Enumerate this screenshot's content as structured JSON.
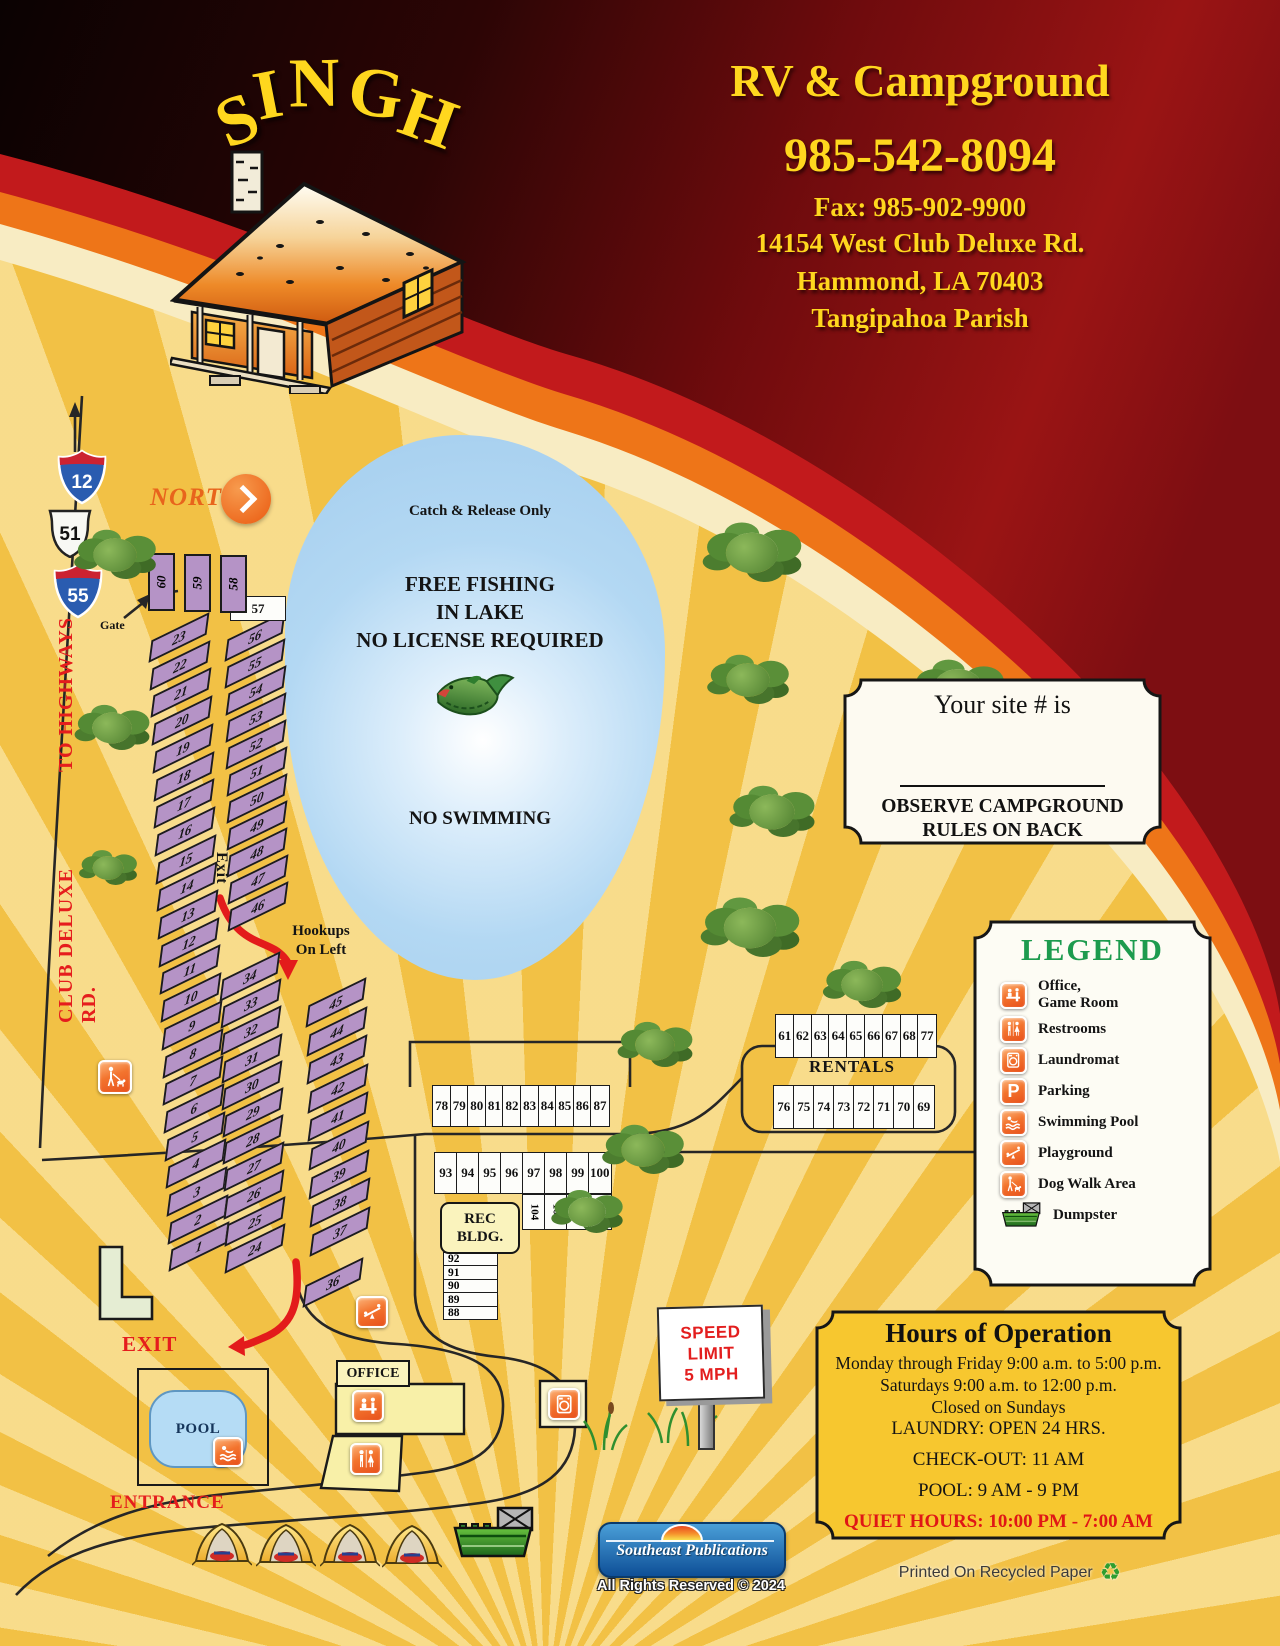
{
  "header": {
    "brand": "SINGH",
    "title": "RV & Campground",
    "phone": "985-542-8094",
    "fax": "Fax: 985-902-9900",
    "address1": "14154 West Club Deluxe Rd.",
    "address2": "Hammond, LA 70403",
    "address3": "Tangipahoa Parish"
  },
  "shields": {
    "i12": "12",
    "us51": "51",
    "i55": "55"
  },
  "labels": {
    "north": "NORTH",
    "gate": "Gate",
    "to_highways": "TO HIGHWAYS",
    "club_deluxe": "CLUB DELUXE RD.",
    "exit_lane": "Exit",
    "hookups1": "Hookups",
    "hookups2": "On Left",
    "exit": "EXIT",
    "entrance": "ENTRANCE",
    "pool": "POOL",
    "office": "OFFICE",
    "rec1": "REC",
    "rec2": "BLDG.",
    "rentals": "RENTALS"
  },
  "lake": {
    "line1": "Catch & Release Only",
    "f1": "FREE FISHING",
    "f2": "IN LAKE",
    "f3": "NO LICENSE REQUIRED",
    "no_swim": "NO SWIMMING"
  },
  "speed_sign": {
    "l1": "SPEED",
    "l2": "LIMIT",
    "l3": "5 MPH"
  },
  "sites": {
    "colA": [
      "23",
      "22",
      "21",
      "20",
      "19",
      "18",
      "17",
      "16",
      "15",
      "14",
      "13",
      "12",
      "11",
      "10",
      "9",
      "8",
      "7",
      "6",
      "5",
      "4",
      "3",
      "2",
      "1"
    ],
    "colD": [
      "56",
      "55",
      "54",
      "53",
      "52",
      "51",
      "50",
      "49",
      "48",
      "47",
      "46"
    ],
    "colB": [
      "34",
      "33",
      "32",
      "31",
      "30",
      "29",
      "28",
      "27",
      "26",
      "25",
      "24"
    ],
    "colE": [
      "45",
      "44",
      "43",
      "42",
      "41",
      "40",
      "39",
      "38",
      "37"
    ],
    "site36": [
      "36"
    ],
    "site57": [
      "57"
    ],
    "laneTop": [
      "60",
      "59",
      "58"
    ],
    "row78": [
      "78",
      "79",
      "80",
      "81",
      "82",
      "83",
      "84",
      "85",
      "86",
      "87"
    ],
    "row93": [
      "93",
      "94",
      "95",
      "96",
      "97",
      "98",
      "99",
      "100"
    ],
    "rowVert": [
      "104",
      "103",
      "102",
      "101"
    ],
    "rec_sites": [
      "92",
      "91",
      "90",
      "89",
      "88"
    ],
    "rentals_top": [
      "61",
      "62",
      "63",
      "64",
      "65",
      "66",
      "67",
      "68",
      "77"
    ],
    "rentals_bottom": [
      "76",
      "75",
      "74",
      "73",
      "72",
      "71",
      "70",
      "69"
    ]
  },
  "site_box": {
    "title": "Your site # is",
    "line1": "OBSERVE CAMPGROUND",
    "line2": "RULES ON BACK"
  },
  "legend": {
    "title": "LEGEND",
    "items": [
      {
        "icon": "office-gameroom-icon",
        "line1": "Office,",
        "line2": "Game Room"
      },
      {
        "icon": "restrooms-icon",
        "line1": "Restrooms"
      },
      {
        "icon": "laundromat-icon",
        "line1": "Laundromat"
      },
      {
        "icon": "parking-icon",
        "line1": "Parking"
      },
      {
        "icon": "swimming-pool-icon",
        "line1": "Swimming Pool"
      },
      {
        "icon": "playground-icon",
        "line1": "Playground"
      },
      {
        "icon": "dog-walk-icon",
        "line1": "Dog Walk Area"
      },
      {
        "icon": "dumpster-icon",
        "line1": "Dumpster"
      }
    ]
  },
  "hours": {
    "title": "Hours of Operation",
    "line1": "Monday through Friday 9:00 a.m. to 5:00 p.m.",
    "line2": "Saturdays 9:00 a.m. to 12:00 p.m.",
    "line3": "Closed on Sundays",
    "line4": "LAUNDRY: OPEN 24 HRS.",
    "line5": "CHECK-OUT: 11 AM",
    "line6": "POOL: 9 AM - 9 PM",
    "quiet": "QUIET HOURS: 10:00 PM - 7:00 AM"
  },
  "footer": {
    "publisher": "Southeast Publications",
    "rights": "All Rights Reserved © 2024",
    "recycled": "Printed On Recycled Paper"
  },
  "colors": {
    "page_gold": "#F2C145",
    "site_purple": "#B593C6",
    "lake_blue": "#ABD3F0",
    "legend_green": "#1D9B4E",
    "icon_orange": "#EF5A22",
    "swoosh_dark": "#7D0E12",
    "swoosh_red": "#C21A1C",
    "swoosh_orange": "#EE7518",
    "swoosh_cream": "#F8ECC3",
    "header_yellow": "#FFD71E",
    "red_label": "#E51D1D"
  }
}
